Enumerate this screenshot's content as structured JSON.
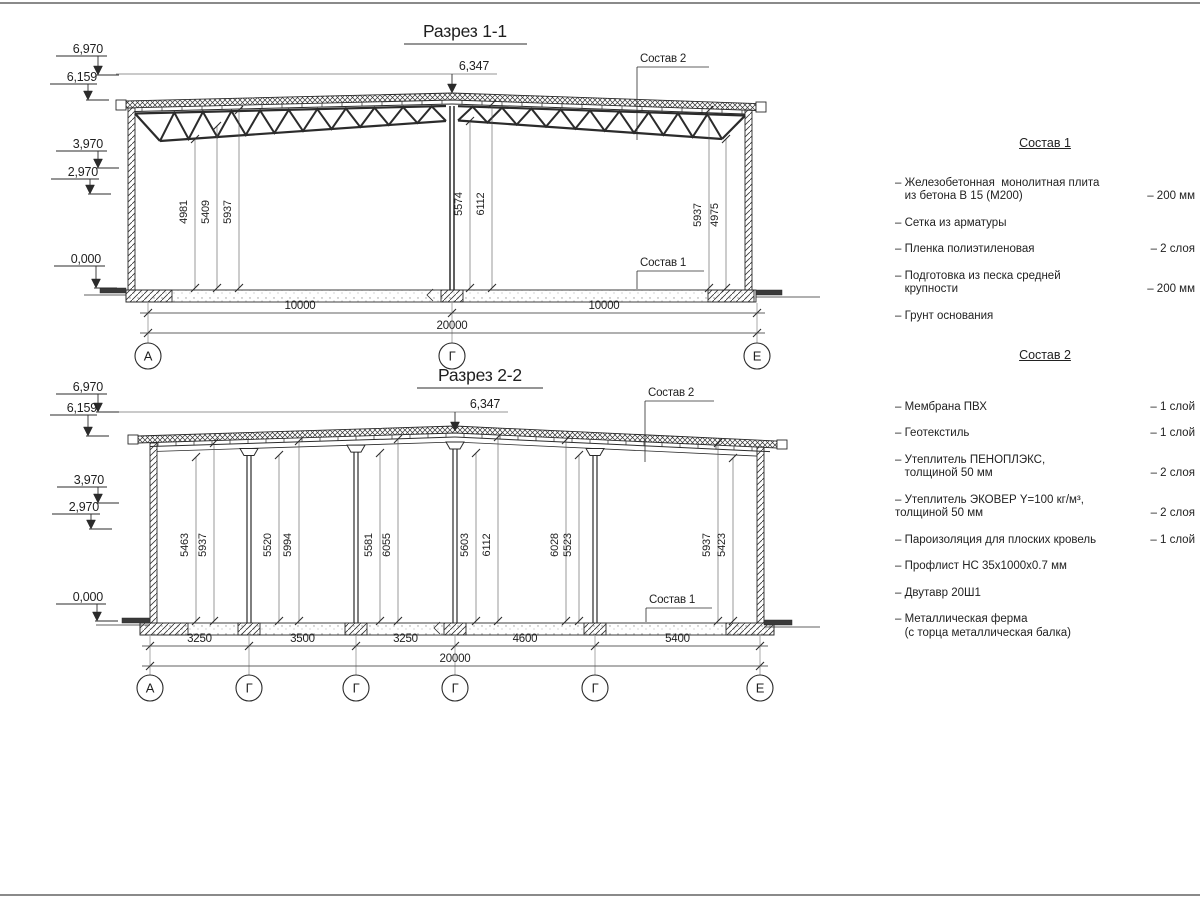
{
  "section1": {
    "title": "Разрез 1-1",
    "apex_dim": "6,347",
    "elevations": [
      "6,970",
      "6,159",
      "3,970",
      "2,970",
      "0,000"
    ],
    "vertical_dims": [
      "4981",
      "5409",
      "5937",
      "5574",
      "6112",
      "5937",
      "4975"
    ],
    "bottom_dims": [
      "10000",
      "10000"
    ],
    "overall_dim": "20000",
    "axes": [
      "А",
      "Г",
      "Е"
    ],
    "sostav2_label": "Состав 2",
    "sostav1_label": "Состав 1"
  },
  "section2": {
    "title": "Разрез 2-2",
    "apex_dim": "6,347",
    "elevations": [
      "6,970",
      "6,159",
      "3,970",
      "2,970",
      "0,000"
    ],
    "vertical_dims": [
      "5463",
      "5937",
      "5520",
      "5994",
      "5581",
      "6055",
      "5603",
      "6112",
      "6028",
      "5523",
      "5937",
      "5423"
    ],
    "bottom_dims": [
      "3250",
      "3500",
      "3250",
      "4600",
      "5400"
    ],
    "overall_dim": "20000",
    "axes": [
      "А",
      "Г",
      "Г",
      "Г",
      "Г",
      "Е"
    ],
    "sostav2_label": "Состав 2",
    "sostav1_label": "Состав 1"
  },
  "legend1": {
    "title": "Состав 1",
    "items": [
      {
        "name": "– Железобетонная  монолитная плита\n   из бетона В 15 (М200)",
        "value": "– 200 мм"
      },
      {
        "name": "– Сетка из арматуры",
        "value": ""
      },
      {
        "name": "– Пленка полиэтиленовая",
        "value": "– 2 слоя"
      },
      {
        "name": "– Подготовка из песка средней\n   крупности",
        "value": "– 200 мм"
      },
      {
        "name": "– Грунт основания",
        "value": ""
      }
    ]
  },
  "legend2": {
    "title": "Состав 2",
    "items": [
      {
        "name": "– Мембрана ПВХ",
        "value": "– 1 слой"
      },
      {
        "name": "– Геотекстиль",
        "value": "– 1 слой"
      },
      {
        "name": "– Утеплитель ПЕНОПЛЭКС,\n   толщиной 50 мм",
        "value": "– 2 слоя"
      },
      {
        "name": "– Утеплитель ЭКОВЕР Y=100 кг/м³,\nтолщиной 50 мм",
        "value": "– 2 слоя"
      },
      {
        "name": "– Пароизоляция для плоских кровель",
        "value": "– 1 слой"
      },
      {
        "name": "– Профлист НС 35х1000х0.7 мм",
        "value": ""
      },
      {
        "name": "– Двутавр 20Ш1",
        "value": ""
      },
      {
        "name": "– Металлическая ферма\n   (с торца металлическая балка)",
        "value": ""
      }
    ]
  }
}
